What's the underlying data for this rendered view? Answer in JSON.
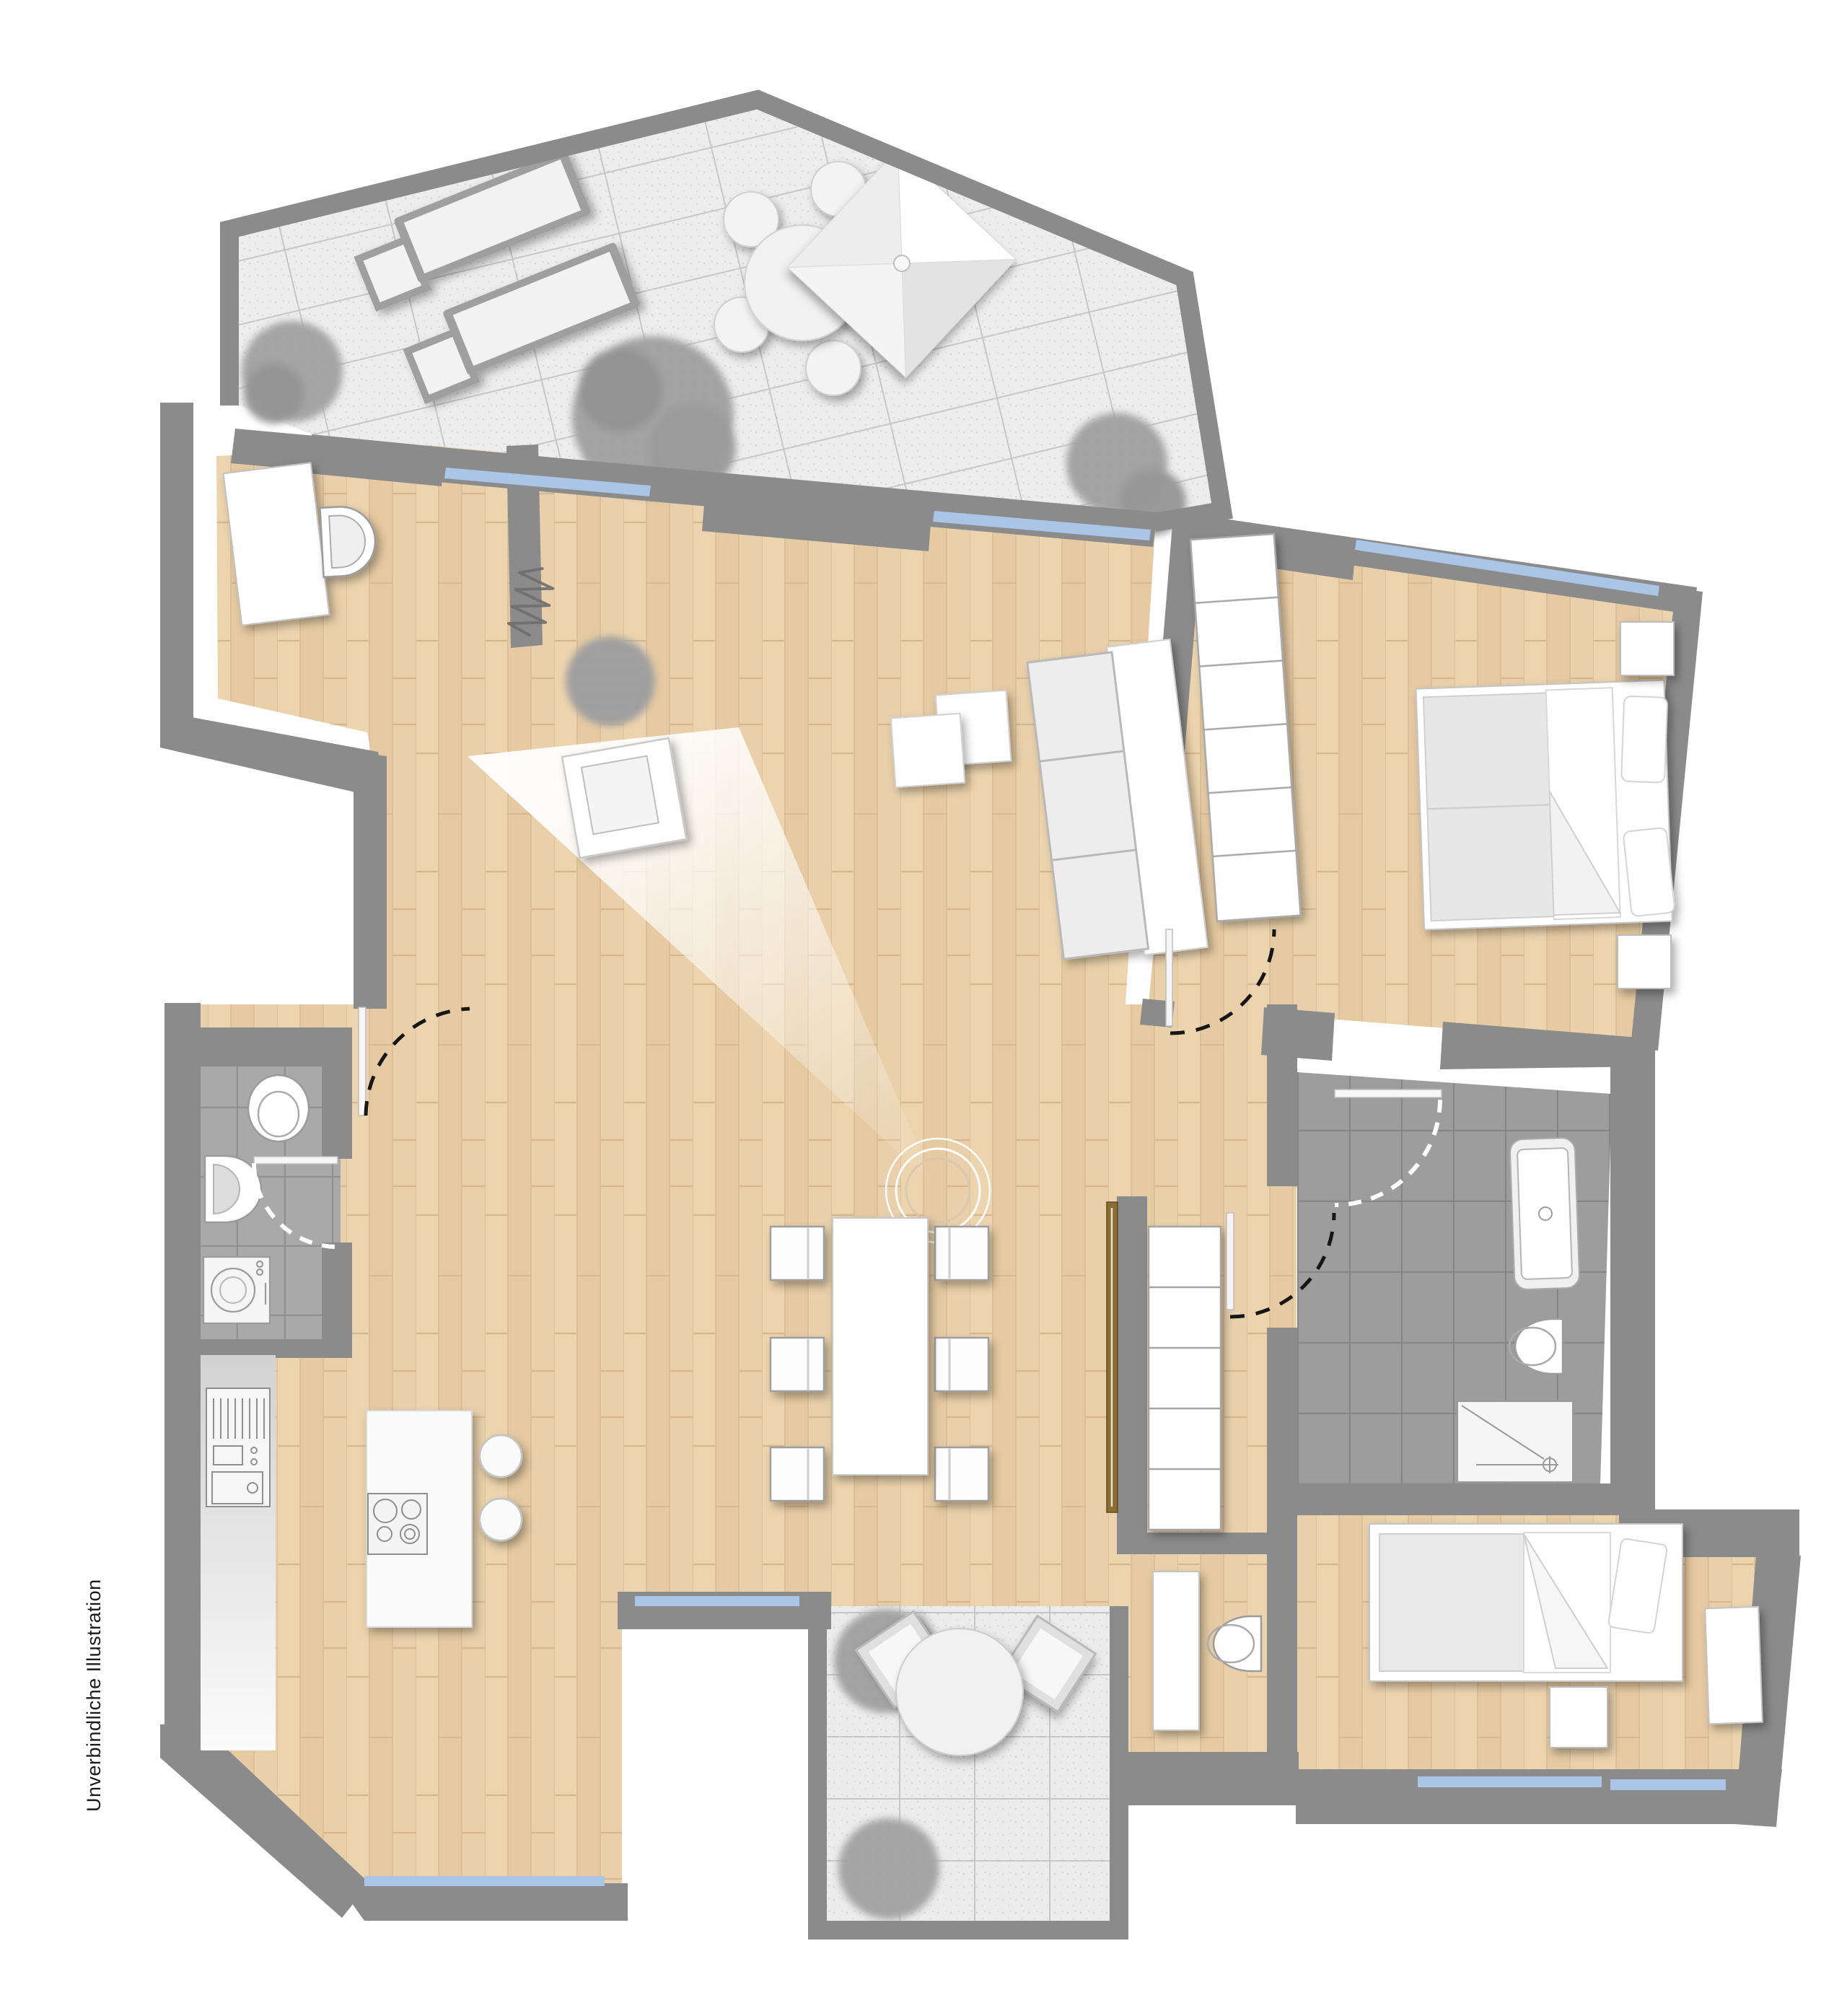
{
  "caption": "Unverbindliche Illustration",
  "palette": {
    "wall": "#8b8b8b",
    "wood_floor": "#e8cfa9",
    "terrace_tile": "#ededed",
    "terrace_grout": "#c7c7c7",
    "bath_tile_small": "#a9a9a9",
    "bath_tile_main": "#9d9d9d",
    "window_glass": "#aac5e6",
    "furniture_fill": "#ffffff",
    "furniture_outline": "#9f9f9f",
    "cushion": "#e9e9e9",
    "sliding_door": "#8a6d33",
    "foliage": "#9b9b9b",
    "door_swing_black": "#161616",
    "door_swing_white": "#ffffff"
  },
  "elements": {
    "roof_terrace": [
      "parasol",
      "terrace-round-table",
      "terrace-chair",
      "sun-lounger",
      "bush"
    ],
    "entry": [
      "sideboard",
      "toilet"
    ],
    "living_room": [
      "sofa",
      "coffee-table",
      "armchair",
      "potted-plant",
      "radiator-coil",
      "light-beam"
    ],
    "dining": [
      "dining-table",
      "dining-chair",
      "pendant-lamp-rings"
    ],
    "kitchen": [
      "kitchen-counter",
      "oven-unit",
      "kitchen-island",
      "cooktop",
      "bar-stool"
    ],
    "guest_bath": [
      "toilet",
      "washbasin",
      "washing-machine",
      "door-leaf",
      "door-swing-arc"
    ],
    "hallway": [
      "sliding-door",
      "hall-shelf",
      "door-leaf",
      "door-swing-arc"
    ],
    "bedroom": [
      "double-bed",
      "pillow",
      "duvet",
      "nightstand",
      "wardrobe"
    ],
    "main_bath": [
      "bathtub",
      "toilet",
      "shower",
      "door-leaf",
      "door-swing-arc"
    ],
    "wc": [
      "vanity-cabinet",
      "toilet"
    ],
    "kids_room": [
      "single-bed",
      "pillow",
      "duvet",
      "nightstand",
      "dresser"
    ],
    "lower_terrace": [
      "terrace-round-table",
      "terrace-chair",
      "bush"
    ],
    "openings": [
      "window-glazing",
      "door-swing-arc"
    ]
  }
}
